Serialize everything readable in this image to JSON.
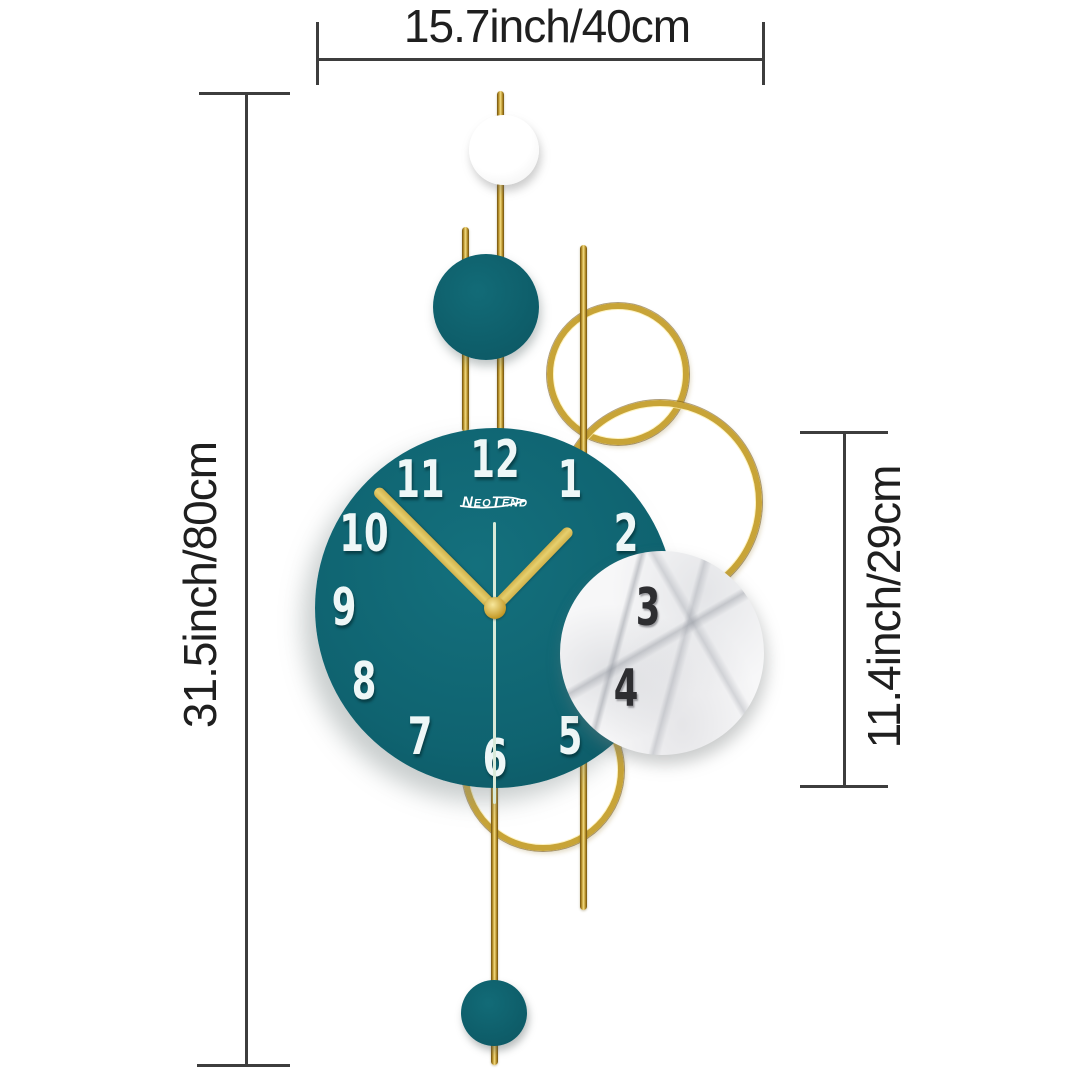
{
  "dimensions": {
    "width_label": "15.7inch/40cm",
    "height_label": "31.5inch/80cm",
    "clock_height_label": "11.4inch/29cm"
  },
  "clock": {
    "brand": "NeoTend",
    "numerals": [
      "12",
      "1",
      "2",
      "3",
      "4",
      "5",
      "6",
      "7",
      "8",
      "9",
      "10",
      "11"
    ],
    "time_shown": "1:50:30"
  },
  "colors": {
    "teal": "#0f6370",
    "teal_dark": "#0d5a66",
    "gold": "#c8a437",
    "gold_dark": "#6e4f0e",
    "gold_light": "#f3dc82",
    "hand": "#e6cf6e",
    "second_hand": "#d9ead9",
    "numeral_white": "#eef7f7",
    "numeral_dark": "#2e2e31",
    "dimension_line": "#3d3d3d",
    "marble_base": "#f7f7f8"
  }
}
